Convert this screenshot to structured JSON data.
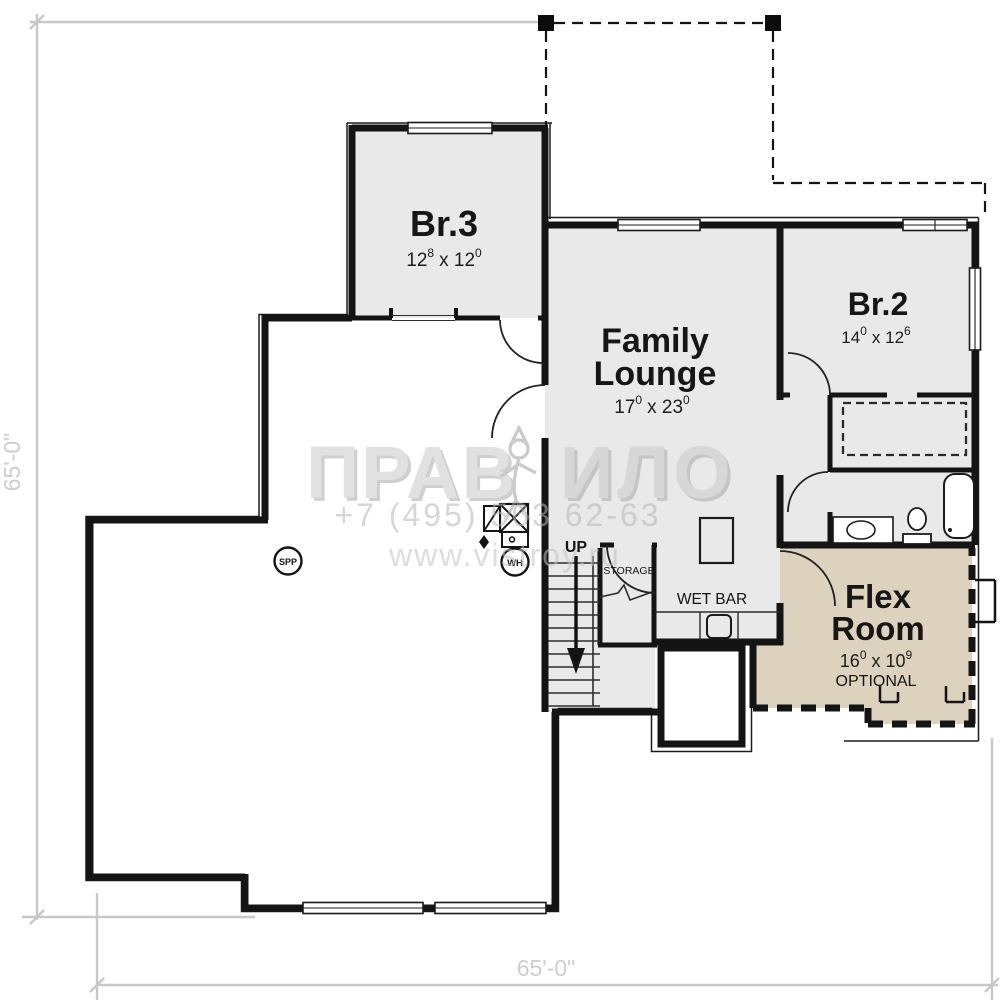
{
  "plan": {
    "type": "basement-floor-plan",
    "dimension_left": "65'-0\"",
    "dimension_bottom": "65'-0\""
  },
  "rooms": {
    "br3": {
      "name": "Br.3",
      "dim": [
        "12",
        "8",
        "x 12",
        "0"
      ]
    },
    "family_lounge": {
      "name_line1": "Family",
      "name_line2": "Lounge",
      "dim": [
        "17",
        "0",
        "x 23",
        "0"
      ]
    },
    "br2": {
      "name": "Br.2",
      "dim": [
        "14",
        "0",
        "x 12",
        "6"
      ]
    },
    "flex": {
      "name_line1": "Flex",
      "name_line2": "Room",
      "dim": [
        "16",
        "0",
        "x 10",
        "9"
      ],
      "note": "OPTIONAL"
    }
  },
  "labels": {
    "wet_bar": "WET BAR",
    "storage": "STORAGE",
    "up": "UP",
    "spp": "SPP",
    "wh": "WH"
  },
  "watermark": {
    "brand_left": "ПРАВ",
    "brand_right": "ИЛО",
    "phone": "+7 (495) 563 62-63",
    "url": "www.vistroy.ru"
  },
  "colors": {
    "room_fill": "#e9e9e9",
    "flex_fill": "#ddd2bd",
    "wall": "#141414",
    "dimension_gray": "#c8c8c8",
    "watermark_gray": "#c2c2c2"
  }
}
